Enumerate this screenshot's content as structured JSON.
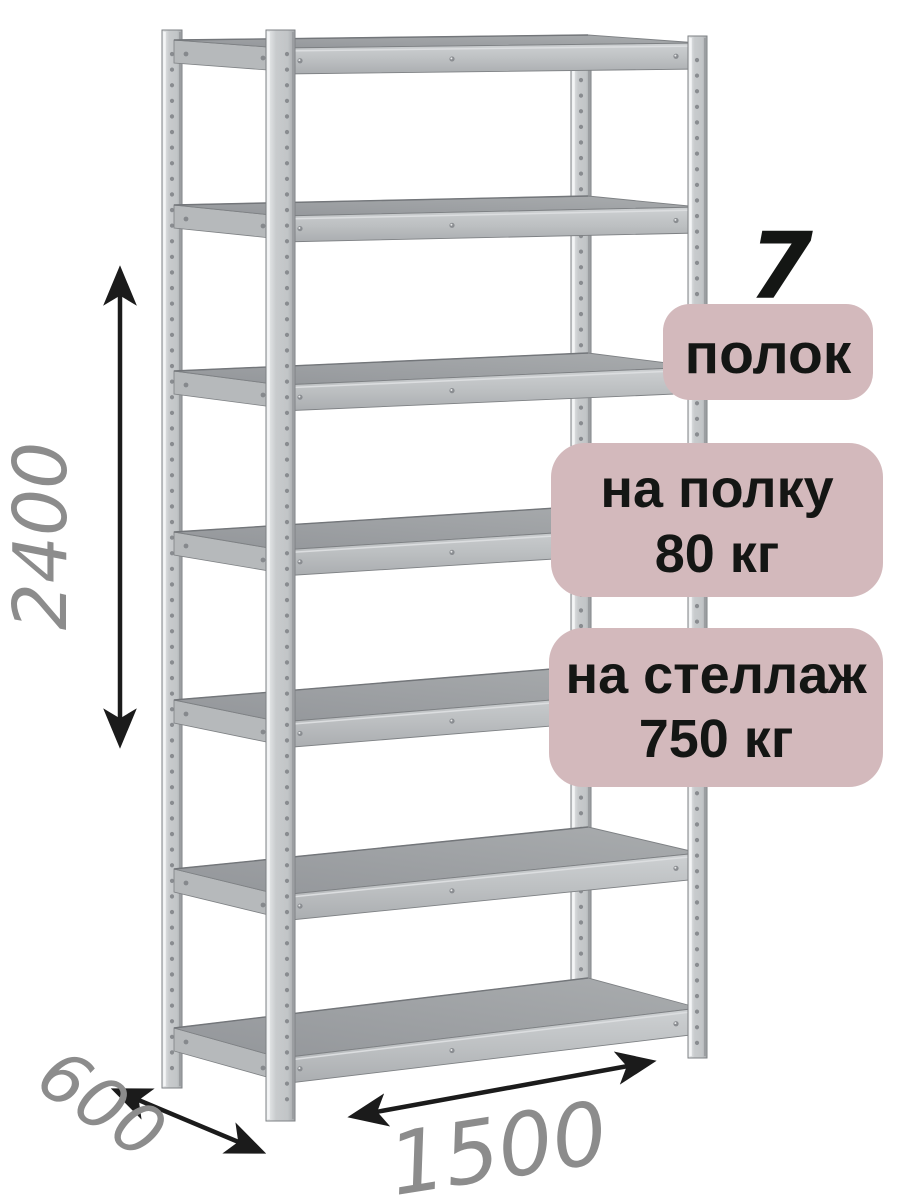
{
  "illustration": {
    "subject": "metal-shelving-rack",
    "shelf_count_drawn": 7
  },
  "dimensions": {
    "height_mm": "2400",
    "depth_mm": "600",
    "width_mm": "1500"
  },
  "badges": {
    "shelf_count": "7",
    "shelf_count_unit": "полок",
    "shelf_load_line1": "на полку",
    "shelf_load_line2": "80 кг",
    "rack_load_line1": "на стеллаж",
    "rack_load_line2": "750 кг"
  },
  "colors": {
    "badge_bg": "#d3b9bc",
    "badge_text": "#141614",
    "dimension_text": "#8c8c8c",
    "arrow": "#1b1b1b",
    "metal_light": "#c8cbcd",
    "metal_beam": "#bfc2c4",
    "metal_surface": "#9b9ea1",
    "metal_edge": "#7e8184",
    "background": "#ffffff"
  }
}
